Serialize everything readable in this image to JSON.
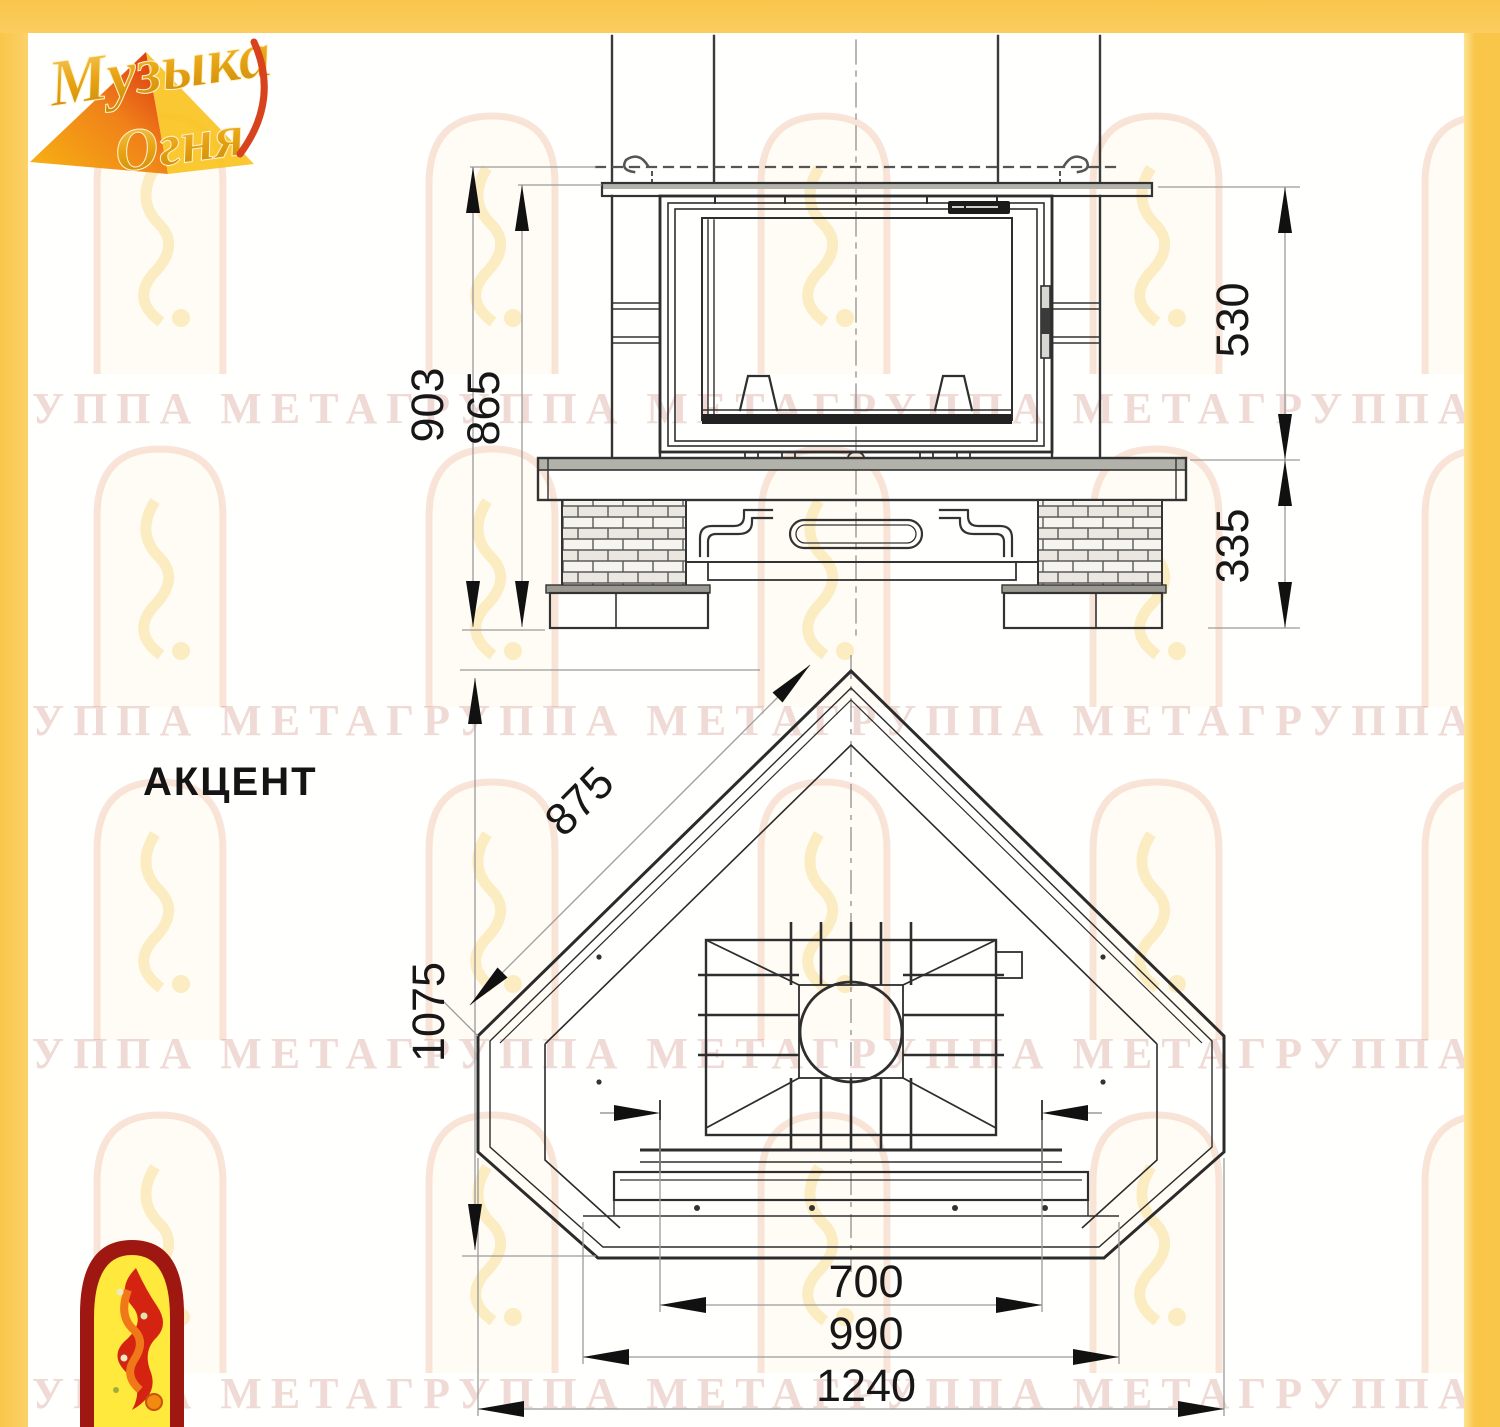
{
  "logo": {
    "word1": "Музыка",
    "word2": "Огня"
  },
  "product": {
    "title": "АКЦЕНТ"
  },
  "watermark": {
    "text": "ГРУППА МЕТАГРУППА МЕТАГРУППА МЕТАГРУППА МЕТА"
  },
  "front_view": {
    "dims": {
      "total_height": "903",
      "mantel_height": "865",
      "portal_height": "530",
      "base_height": "335"
    }
  },
  "top_view": {
    "dims": {
      "side_depth": "875",
      "total_depth": "1075",
      "firebox_width": "700",
      "mid_width": "990",
      "total_width": "1240"
    }
  },
  "colors": {
    "frame_yellow": "#f9c64a",
    "logo_gold": "#e8a414",
    "logo_red": "#c22310",
    "arch_yellow": "#ffe93c"
  }
}
